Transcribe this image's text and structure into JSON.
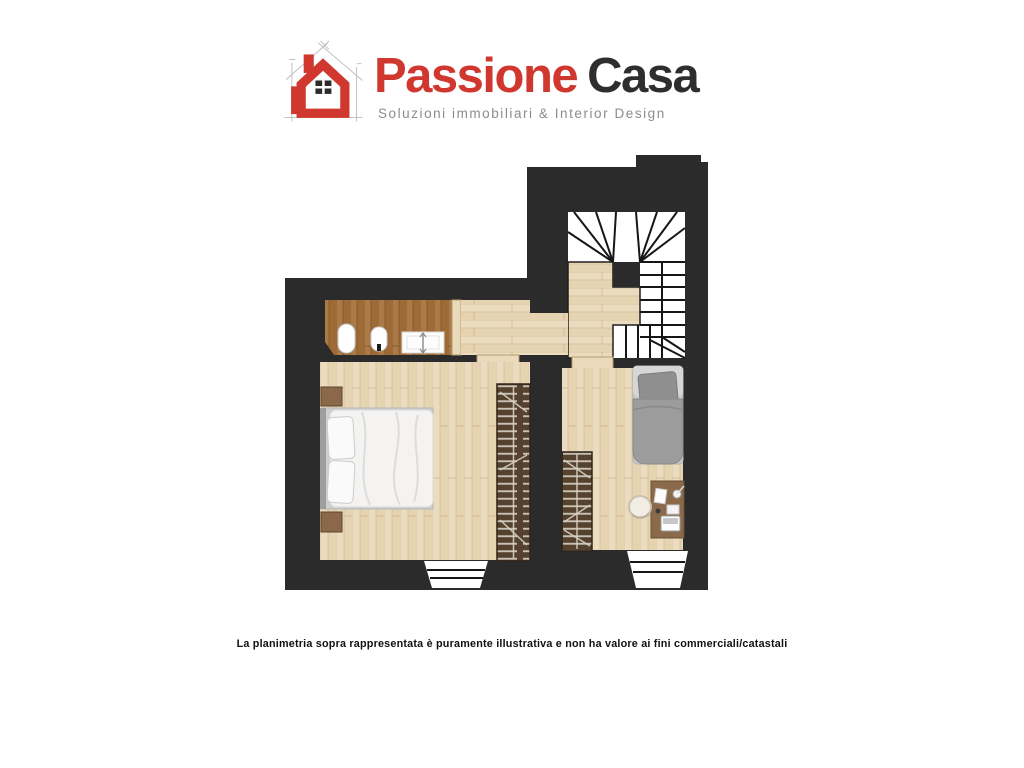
{
  "logo": {
    "brand_primary": "Passione",
    "brand_secondary": "Casa",
    "tagline": "Soluzioni immobiliari & Interior Design"
  },
  "footer": {
    "disclaimer": "La planimetria sopra rappresentata è puramente illustrativa e non ha valore ai fini commerciali/catastali"
  },
  "colors": {
    "accent_red": "#d0372f",
    "brand_dark": "#2e2e2e",
    "tagline_gray": "#8c8c8c",
    "wall": "#2b2b2b",
    "wood_light": "#ecdcbf",
    "wood_dark": "#ab7a46",
    "wardrobe_brown": "#55422e",
    "bed_gray": "#9c9c9c",
    "stair_white": "#ffffff"
  }
}
